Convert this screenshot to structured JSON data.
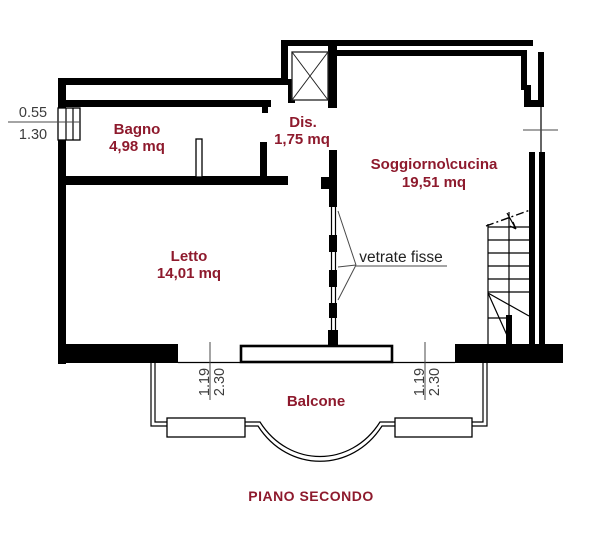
{
  "plan": {
    "title": "PIANO SECONDO",
    "rooms": {
      "bagno": {
        "name": "Bagno",
        "area": "4,98 mq"
      },
      "dis": {
        "name": "Dis.",
        "area": "1,75 mq"
      },
      "soggiorno": {
        "name": "Soggiorno\\cucina",
        "area": "19,51 mq"
      },
      "letto": {
        "name": "Letto",
        "area": "14,01 mq"
      },
      "balcone": {
        "name": "Balcone"
      }
    },
    "annotations": {
      "fixed_glazing": "vetrate fisse"
    },
    "dimensions": {
      "left_window": {
        "num": "0.55",
        "den": "1.30"
      },
      "balcony_left": {
        "num": "1.19",
        "den": "2.30"
      },
      "balcony_right": {
        "num": "1.19",
        "den": "2.30"
      }
    },
    "colors": {
      "room_label": "#8e1a2d",
      "wall": "#000000",
      "dimension_text": "#3c3c3c"
    }
  }
}
